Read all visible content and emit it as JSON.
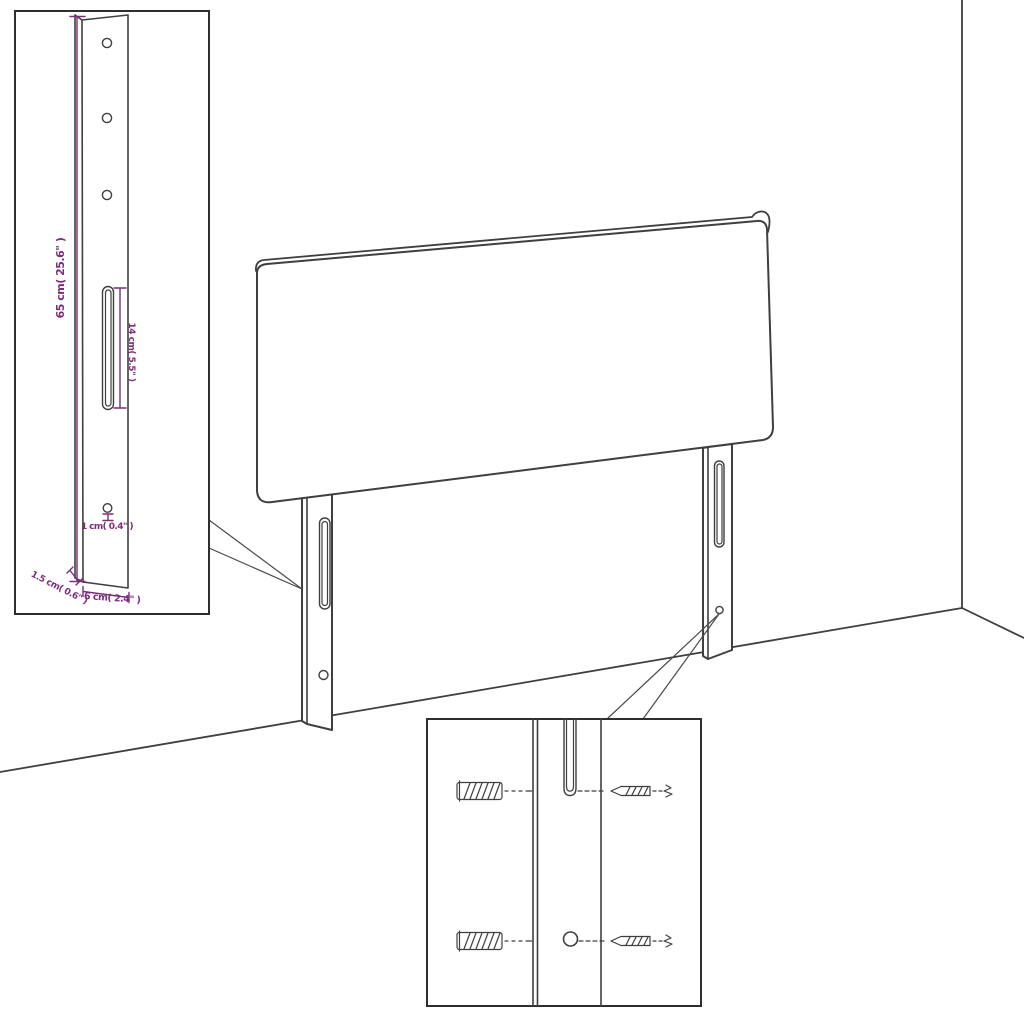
{
  "colors": {
    "line": "#3f3f3f",
    "dimension": "#7b2d7a",
    "callout": "#4a4a4a",
    "background": "#ffffff"
  },
  "dimensions": {
    "leg_height": "65 cm( 25.6\" )",
    "slot_length": "14 cm( 5.5\" )",
    "hole_diameter": "1 cm( 0.4\" )",
    "side_thickness": "1.5 cm( 0.6\" )",
    "leg_width": "6 cm( 2.4\" )"
  }
}
